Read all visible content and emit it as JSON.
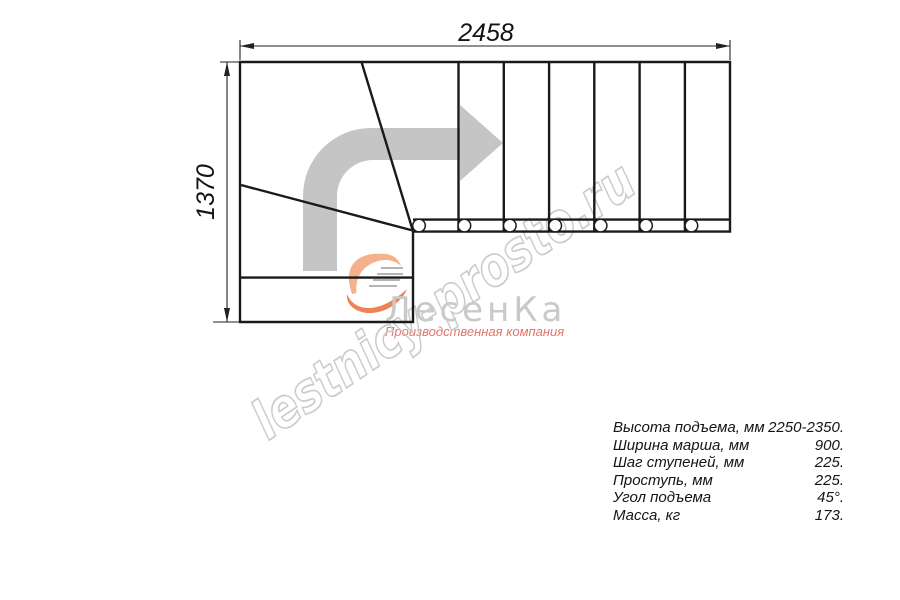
{
  "drawing": {
    "title": "L-shaped staircase plan view",
    "width_dim": "2458",
    "height_dim": "1370"
  },
  "watermark": {
    "site": "lestnicy-prosto.ru"
  },
  "logo": {
    "name": "ЛесенКа",
    "tagline": "Производственная компания"
  },
  "specs": {
    "rows": [
      {
        "label": "Высота подъема, мм",
        "value": "2250-2350."
      },
      {
        "label": "Ширина марша, мм",
        "value": "900."
      },
      {
        "label": "Шаг ступеней, мм",
        "value": "225."
      },
      {
        "label": "Проступь, мм",
        "value": "225."
      },
      {
        "label": "Угол подъема",
        "value": "45°."
      },
      {
        "label": "Масса, кг",
        "value": "173."
      }
    ]
  },
  "colors": {
    "line": "#1a1a1a",
    "dimension_line": "#222222",
    "arrow_gray": "#c5c5c5",
    "watermark_gray": "#cbcbcb",
    "logo_text_gray": "#c9c9c9",
    "logo_orange_light": "#f5b08c",
    "logo_orange_deep": "#ee8455",
    "logo_tagline_red": "#e2756b",
    "speed_lines_gray": "#b5b5b5"
  }
}
